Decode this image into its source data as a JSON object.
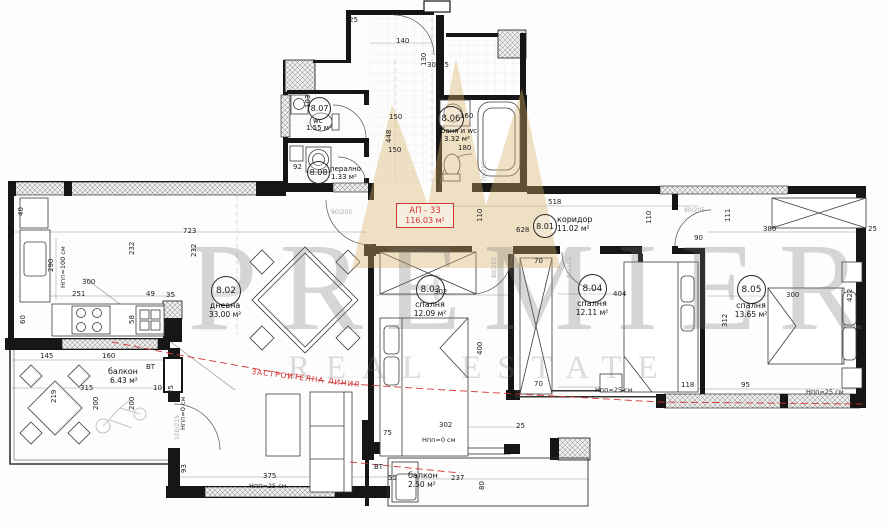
{
  "apartment": {
    "label": "АП - 33",
    "area": "116.03 м²"
  },
  "rooms": [
    {
      "id": "8.01",
      "name": "коридор",
      "area": "11.02 м²"
    },
    {
      "id": "8.02",
      "name": "дневна",
      "area": "33.00 м²"
    },
    {
      "id": "8.03",
      "name": "спалня",
      "area": "12.09 м²"
    },
    {
      "id": "8.04",
      "name": "спалня",
      "area": "12.11 м²"
    },
    {
      "id": "8.05",
      "name": "спалня",
      "area": "13.65 м²"
    },
    {
      "id": "8.06",
      "name": "баня и wc",
      "area": "3.32 м²"
    },
    {
      "id": "8.07",
      "name": "wc",
      "area": "1.55 м²"
    },
    {
      "id": "8.08",
      "name": "перално",
      "area": "1.33 м²"
    }
  ],
  "balconies": [
    {
      "name": "балкон",
      "area": "6.43 м²"
    },
    {
      "name": "балкон",
      "area": "2.50 м²"
    }
  ],
  "annotations": {
    "building_line": "ЗАСТРОИТЕЛНА ЛИНИЯ",
    "vt": "ВТ",
    "npp25": "Нпп=25 см",
    "npp0": "Нпп=0 см",
    "npp100": "Нпп=100 см"
  },
  "door_labels": [
    "90/205",
    "80/205",
    "80/205",
    "80/205",
    "100/215",
    "70/205"
  ],
  "dims": [
    "723",
    "518",
    "628",
    "110",
    "448",
    "150",
    "150",
    "160",
    "180",
    "140",
    "130",
    "30",
    "25",
    "92",
    "103",
    "40",
    "290",
    "232",
    "232",
    "300",
    "251",
    "49",
    "35",
    "58",
    "60",
    "145",
    "160",
    "315",
    "10",
    "25",
    "219",
    "200",
    "200",
    "93",
    "375",
    "302",
    "75",
    "55",
    "237",
    "80",
    "25",
    "302",
    "400",
    "70",
    "404",
    "70",
    "118",
    "95",
    "380",
    "25",
    "90",
    "111",
    "110",
    "312",
    "300",
    "422",
    "25"
  ],
  "watermark": {
    "line1": "PREMIER",
    "line2": "REAL ESTATE"
  },
  "colors": {
    "accent_red": "#d23434",
    "wall": "#161616",
    "watermark_gold": "#d8b163",
    "watermark_gray": "#6f6f6f"
  }
}
